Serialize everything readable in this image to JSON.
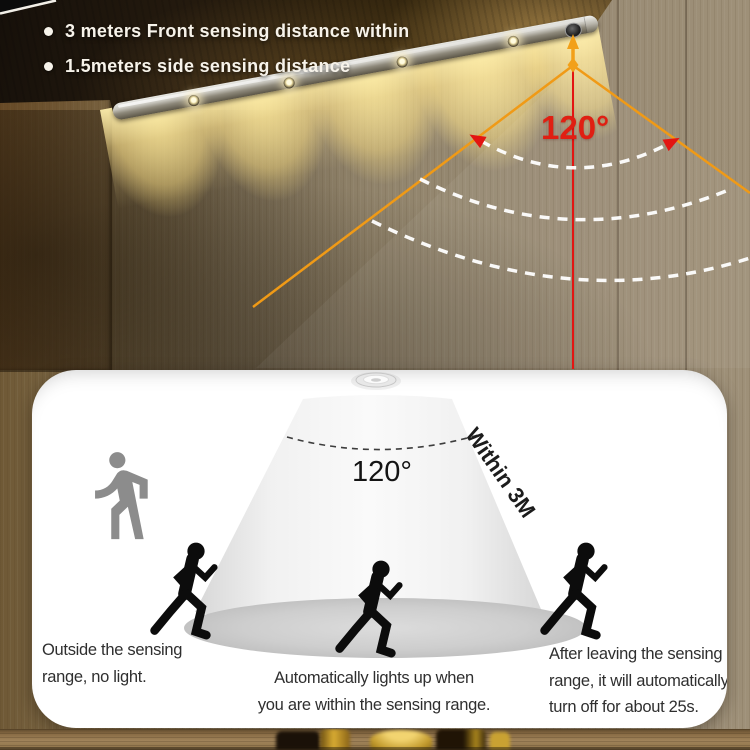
{
  "product_features": {
    "bullets": [
      "3 meters Front sensing distance within",
      "1.5meters side sensing distance"
    ]
  },
  "wall_annotation": {
    "angle_label": "120°"
  },
  "panel_diagram": {
    "angle_label": "120°",
    "range_label": "Within 3M",
    "caption_outside": [
      "Outside the sensing",
      "range, no light."
    ],
    "caption_inside": [
      "Automatically lights up when",
      "you are within the sensing range."
    ],
    "caption_leaving": [
      "After leaving the sensing",
      "range, it will automatically",
      "turn off for about 25s."
    ]
  },
  "icons": {
    "wall_fixture": "led-bar-with-pir-sensor",
    "panel_sensor": "recessed-sensor-icon",
    "outside_figure": "walking-person-icon",
    "inside_figure": "running-person-icon",
    "leaving_figure": "running-person-icon"
  },
  "colors": {
    "angle_line": "#f09a16",
    "distance_line": "#e31512",
    "angle_label_wall": "#e01f12",
    "dash_arc_wall": "#ffffff",
    "glow_warm": "#ffe9a8",
    "panel_background": "#ffffff",
    "cone_gray": "#ededed",
    "figure_black": "#0c0c0c",
    "figure_gray": "#8c8c8c",
    "caption_text": "#2f2f2f",
    "bullet_text": "#f7f3ea"
  }
}
